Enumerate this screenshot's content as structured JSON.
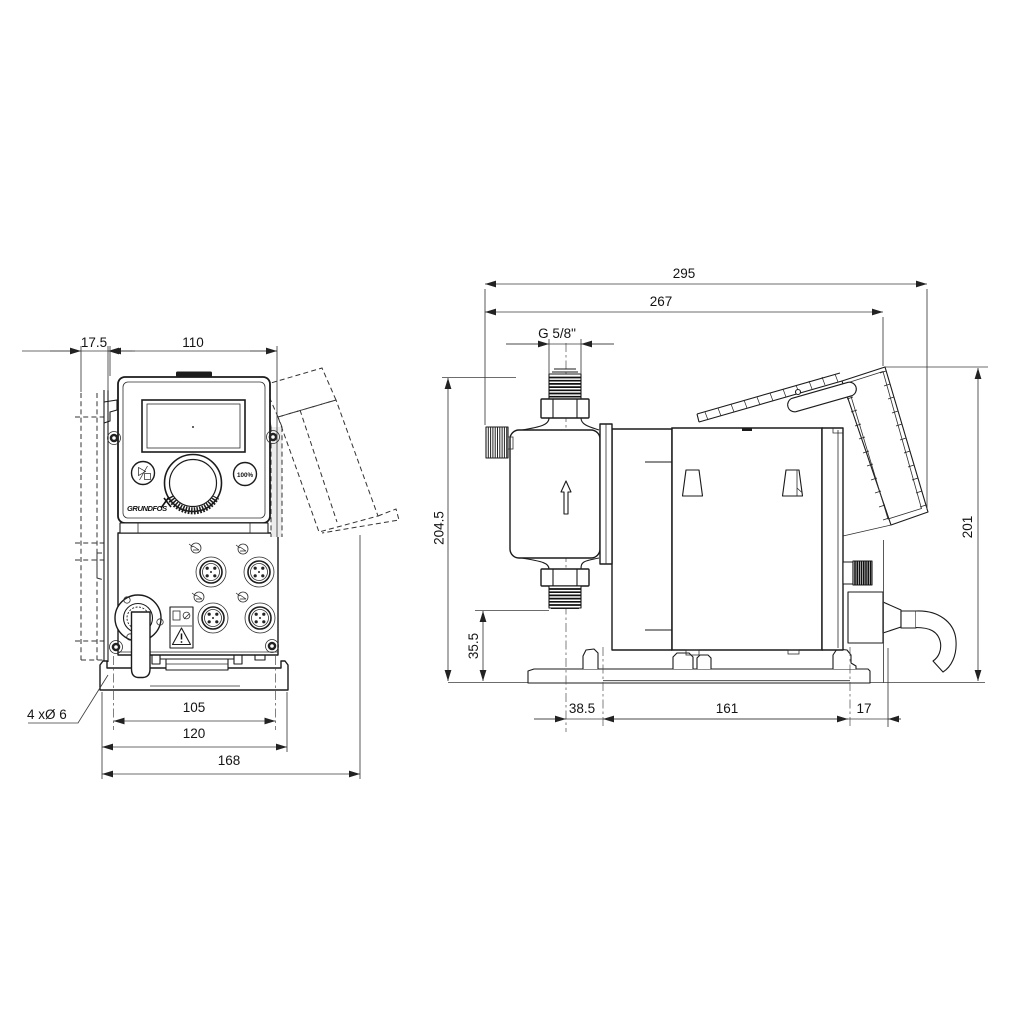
{
  "front_view": {
    "dim_wall_offset": "17.5",
    "dim_width": "110",
    "dim_hole_spacing": "105",
    "dim_base_width": "120",
    "dim_overall_depth": "168",
    "mounting_holes_label": "4 xØ 6",
    "panel": {
      "percent_button_label": "100%",
      "brand": "GRUNDFOS"
    }
  },
  "side_view": {
    "dim_overall_depth": "295",
    "dim_depth_to_bracket": "267",
    "dim_thread": "G 5/8\"",
    "dim_total_height": "204.5",
    "dim_connection_height": "35.5",
    "dim_center_to_hole": "38.5",
    "dim_hole_spacing": "161",
    "dim_hole_to_rear": "17",
    "dim_rear_height": "201"
  }
}
